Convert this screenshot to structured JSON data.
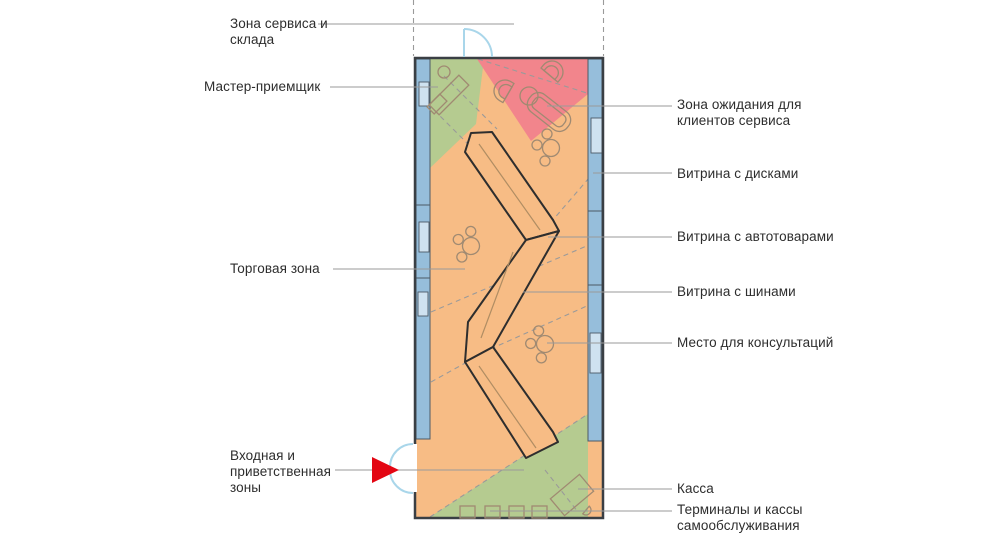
{
  "diagram": {
    "kind": "store-floor-plan",
    "language": "ru"
  },
  "labels": {
    "service_storage": "Зона сервиса и\nсклада",
    "master_receiver": "Мастер-приемщик",
    "trading_zone": "Торговая зона",
    "entrance_welcome": "Входная и\nприветственная\nзоны",
    "waiting_zone": "Зона ожидания для\nклиентов сервиса",
    "showcase_discs": "Витрина с дисками",
    "showcase_auto_goods": "Витрина с автотоварами",
    "showcase_tires": "Витрина с шинами",
    "consultation_spot": "Место для консультаций",
    "cash_desk": "Касса",
    "self_service_terminals": "Терминалы и кассы\nсамообслуживания"
  },
  "colors": {
    "trading_orange": "#f7bc85",
    "zone_green": "#b5cb90",
    "waiting_pink": "#f2858c",
    "showcase_blue": "#96bedb",
    "notch_fill": "#cfe2f0",
    "wall": "#3a3f44",
    "strip_outline": "#4c5a66",
    "furniture_line": "#a08a72",
    "shelf_line": "#2e2e2e",
    "shelf_centerline": "#b08d63",
    "dashed_line": "#9a9a9a",
    "leader_line": "#9a9a9a",
    "door_blue": "#a9d6ea",
    "arrow_red": "#e30613",
    "label_text": "#2d2d2d",
    "background": "#ffffff"
  }
}
